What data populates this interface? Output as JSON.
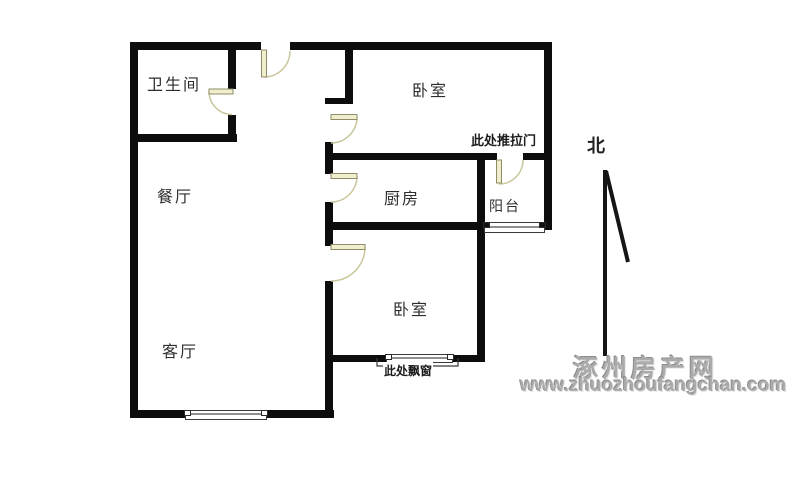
{
  "floor_plan": {
    "rooms": [
      {
        "id": "bathroom",
        "label": "卫生间"
      },
      {
        "id": "dining-room",
        "label": "餐厅"
      },
      {
        "id": "living-room",
        "label": "客厅"
      },
      {
        "id": "bedroom-top",
        "label": "卧室"
      },
      {
        "id": "kitchen",
        "label": "厨房"
      },
      {
        "id": "balcony",
        "label": "阳台"
      },
      {
        "id": "bedroom-bottom",
        "label": "卧室"
      }
    ],
    "annotations": {
      "sliding_door_note": "此处推拉门",
      "bay_window_note": "此处飘窗",
      "north_label": "北"
    },
    "watermark": {
      "site_name": "涿州房产网",
      "site_url": "www.zhuozhoufangchan.com"
    },
    "colors": {
      "wall": "#0d0d0d",
      "door_leaf_fill": "#f1eecd",
      "door_leaf_border": "#8e8c68",
      "door_arc": "#c9c69a",
      "window_border": "#3a3a3a",
      "window_pane_line": "#8f8f8f",
      "label_text": "#2d2d2d",
      "watermark_text": "#ababab"
    }
  }
}
